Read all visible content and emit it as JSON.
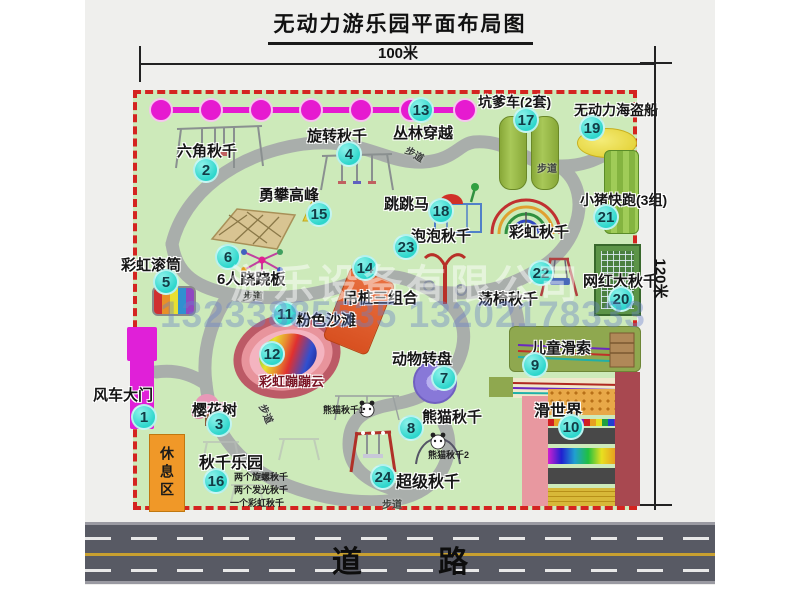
{
  "page": {
    "title": "无动力游乐园平面布局图"
  },
  "dims": {
    "w": "100米",
    "h": "120米"
  },
  "road": {
    "label": "道  路"
  },
  "rest": {
    "label": "休息区"
  },
  "park": {
    "path_label": "步道"
  },
  "watermark": {
    "company": "游乐设备有限公司",
    "phone": "13233885535 13202178333"
  },
  "colors": {
    "badge_cyan": "#2ed6cc",
    "border_red": "#d42420",
    "park_green": "#cdeaba",
    "path_gray": "#a9aeab",
    "magenta": "#e020d8",
    "road_gray": "#585a64",
    "rest_orange": "#f09828"
  },
  "attractions": [
    {
      "num": "1",
      "label": "风车大门"
    },
    {
      "num": "2",
      "label": "六角秋千"
    },
    {
      "num": "3",
      "label": "樱花树"
    },
    {
      "num": "4",
      "label": "旋转秋千"
    },
    {
      "num": "5",
      "label": "彩虹滚筒"
    },
    {
      "num": "6",
      "label": "6人跷跷板"
    },
    {
      "num": "7",
      "label": "动物转盘"
    },
    {
      "num": "8",
      "label": "熊猫秋千",
      "sub1": "熊猫秋千1",
      "sub2": "熊猫秋千2"
    },
    {
      "num": "9",
      "label": "儿童滑索"
    },
    {
      "num": "10",
      "label": "滑世界"
    },
    {
      "num": "11",
      "label": "粉色沙滩"
    },
    {
      "num": "12",
      "label": "彩虹蹦蹦云"
    },
    {
      "num": "13",
      "label": "丛林穿越"
    },
    {
      "num": "14",
      "label": "吊桩三组合"
    },
    {
      "num": "15",
      "label": "勇攀高峰"
    },
    {
      "num": "16",
      "label": "秋千乐园",
      "notes": [
        "两个旋螺秋千",
        "两个发光秋千",
        "一个彩虹秋千"
      ]
    },
    {
      "num": "17",
      "label": "坑爹车(2套)"
    },
    {
      "num": "18",
      "label": "跳跳马"
    },
    {
      "num": "19",
      "label": "无动力海盗船"
    },
    {
      "num": "20",
      "label": "网红大秋千"
    },
    {
      "num": "21",
      "label": "小猪快跑(3组)"
    },
    {
      "num": "22",
      "label": "荡椅秋千"
    },
    {
      "num": "23",
      "label": "泡泡秋千"
    },
    {
      "num": "24",
      "label": "超级秋千"
    },
    {
      "label": "彩虹秋千"
    }
  ]
}
